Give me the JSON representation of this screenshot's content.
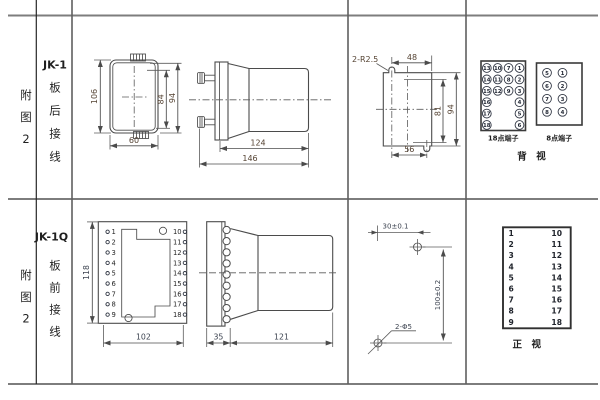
{
  "figure_labels": {
    "row1": {
      "col1_chars": [
        "附",
        "图",
        "2"
      ],
      "model": "JK-1",
      "wiring_chars": [
        "板",
        "后",
        "接",
        "线"
      ]
    },
    "row2": {
      "col1_chars": [
        "附",
        "图",
        "2"
      ],
      "model": "JK-1Q",
      "wiring_chars": [
        "板",
        "前",
        "接",
        "线"
      ]
    }
  },
  "row1": {
    "front_view": {
      "height": "106",
      "width": "60",
      "body_height": "84",
      "overall_height": "94"
    },
    "side_view": {
      "body_depth": "124",
      "overall_depth": "146"
    },
    "panel_cutout": {
      "slots": "2-R2.5",
      "top_width": "48",
      "height_inner": "81",
      "height_outer": "94",
      "bottom_width": "56"
    },
    "terminal_18": {
      "caption": "18点端子",
      "grid": [
        [
          13,
          10,
          7,
          1
        ],
        [
          14,
          11,
          8,
          2
        ],
        [
          15,
          12,
          9,
          3
        ],
        [
          16,
          null,
          null,
          4
        ],
        [
          17,
          null,
          null,
          5
        ],
        [
          18,
          null,
          null,
          6
        ]
      ]
    },
    "terminal_8": {
      "caption": "8点端子",
      "grid": [
        [
          5,
          1
        ],
        [
          6,
          2
        ],
        [
          7,
          3
        ],
        [
          8,
          4
        ]
      ]
    },
    "view_label": "背　视"
  },
  "row2": {
    "connector_front": {
      "height": "118",
      "width": "102",
      "left_pins": [
        1,
        2,
        3,
        4,
        5,
        6,
        7,
        8,
        9
      ],
      "right_pins": [
        10,
        11,
        12,
        13,
        14,
        15,
        16,
        17,
        18
      ]
    },
    "side_view": {
      "plate_depth": "35",
      "body_depth": "121"
    },
    "drill_plan": {
      "hole_spacing_x": "30±0.1",
      "hole_spacing_y": "100±0.2",
      "holes": "2-Φ5"
    },
    "terminal_table": {
      "left": [
        1,
        2,
        3,
        4,
        5,
        6,
        7,
        8,
        9
      ],
      "right": [
        10,
        11,
        12,
        13,
        14,
        15,
        16,
        17,
        18
      ],
      "caption": "正　视"
    }
  }
}
